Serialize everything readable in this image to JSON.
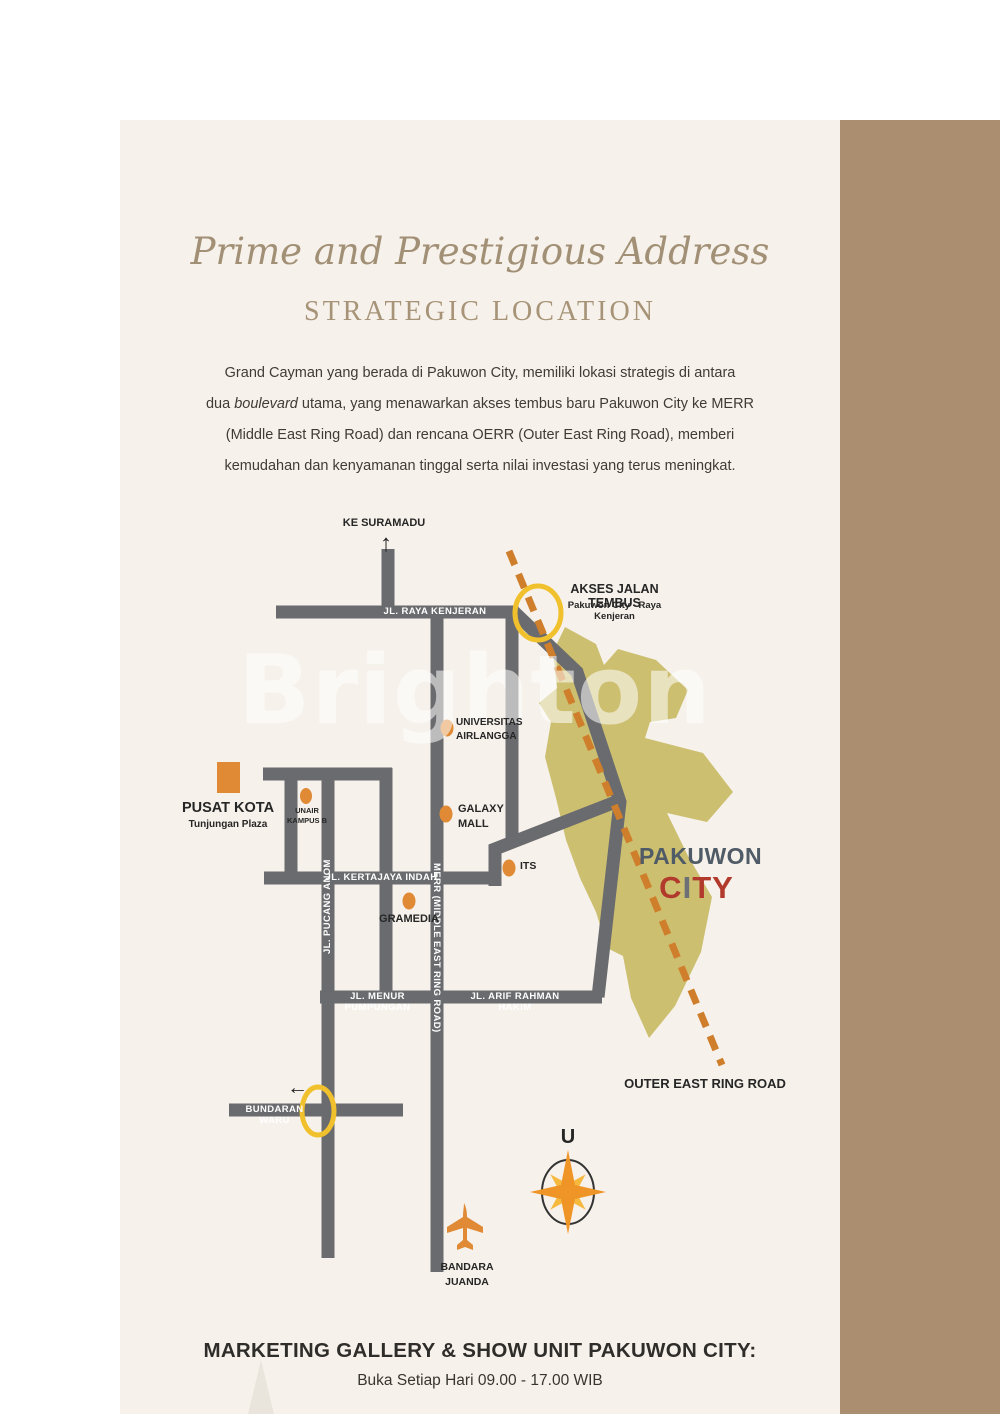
{
  "page": {
    "background": "#ffffff",
    "panel_background": "#f6f1ea",
    "sidebar_color": "#ab8d6f"
  },
  "header": {
    "script_title": "Prime and Prestigious Address",
    "title": "STRATEGIC LOCATION"
  },
  "intro": {
    "line1": "Grand Cayman yang berada di Pakuwon City, memiliki lokasi strategis di antara",
    "line2_pre": "dua ",
    "line2_italic": "boulevard",
    "line2_post": " utama, yang menawarkan akses tembus baru Pakuwon City ke MERR",
    "line3": "(Middle East Ring Road) dan rencana OERR (Outer East Ring Road), memberi",
    "line4": "kemudahan dan kenyamanan tinggal serta nilai investasi yang terus meningkat."
  },
  "map": {
    "watermark": "Brighton",
    "roads": {
      "kenjeran": "JL. RAYA KENJERAN",
      "kertajaya": "JL. KERTAJAYA INDAH",
      "menur": "JL. MENUR PUMPUNGAN",
      "arif": "JL. ARIF RAHMAN HAKIM",
      "bundaran": "BUNDARAN WARU",
      "pucang": "JL. PUCANG ANOM",
      "merr": "MERR (MIDDLE EAST RING ROAD)"
    },
    "labels": {
      "ke_suramadu": "KE SURAMADU",
      "arrow_up": "↑",
      "arrow_left": "←",
      "akses_title": "AKSES JALAN TEMBUS",
      "akses_sub": "Pakuwon City - Raya Kenjeran",
      "universitas_line1": "UNIVERSITAS",
      "universitas_line2": "AIRLANGGA",
      "galaxy_line1": "GALAXY",
      "galaxy_line2": "MALL",
      "its": "ITS",
      "gramedia": "GRAMEDIA",
      "unair_line1": "UNAIR",
      "unair_line2": "KAMPUS B",
      "pusat_kota": "PUSAT KOTA",
      "pusat_kota_sub": "Tunjungan Plaza",
      "pakuwon": "PAKUWON",
      "city_c": "C",
      "city_i": "I",
      "city_ty": "TY",
      "outer_ring_road": "OUTER EAST RING ROAD",
      "compass_north": "U",
      "bandara_line1": "BANDARA",
      "bandara_line2": "JUANDA",
      "ke_tol_line1": "KE TOL",
      "ke_tol_line2": "SURABAYA - GEMPOL"
    },
    "colors": {
      "road": "#6a6b6e",
      "pakuwon_area": "#cdbf70",
      "landmark_orange": "#e08a35",
      "dashed_line": "#cf7e2b",
      "highlight_ring": "#f1c12d",
      "pakuwon_text": "#4f5b66",
      "city_red": "#b23a2c"
    }
  },
  "footer": {
    "line1": "MARKETING GALLERY & SHOW UNIT PAKUWON CITY:",
    "line2": "Buka Setiap Hari 09.00 - 17.00 WIB"
  }
}
